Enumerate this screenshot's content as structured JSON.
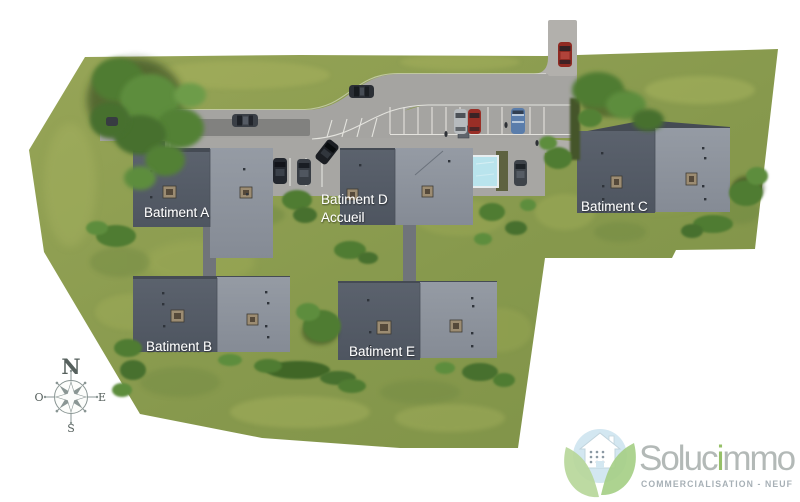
{
  "buildings": [
    {
      "id": "batiment-a",
      "label": "Batiment A"
    },
    {
      "id": "batiment-b",
      "label": "Batiment B"
    },
    {
      "id": "batiment-c",
      "label": "Batiment C"
    },
    {
      "id": "batiment-d",
      "label": "Batiment D",
      "sublabel": "Accueil"
    },
    {
      "id": "batiment-e",
      "label": "Batiment E"
    }
  ],
  "compass": {
    "north": "N",
    "west": "O",
    "east": "E",
    "south": "S"
  },
  "logo": {
    "brand_prefix": "Soluc",
    "brand_accent_letter": "i",
    "brand_suffix": "mmo",
    "tagline": "COMMERCIALISATION - NEUF",
    "accent_color": "#96c068",
    "text_color": "#b3b9b7",
    "tagline_color": "#a7b0b6"
  },
  "colors": {
    "grass": "#8ea254",
    "road": "#a5a4a1",
    "entrance_road": "#b2b0ac",
    "roof_dark": "#565d68",
    "roof_light": "#8d939c",
    "pool": "#b9e4ed",
    "label_text": "#ffffff"
  }
}
